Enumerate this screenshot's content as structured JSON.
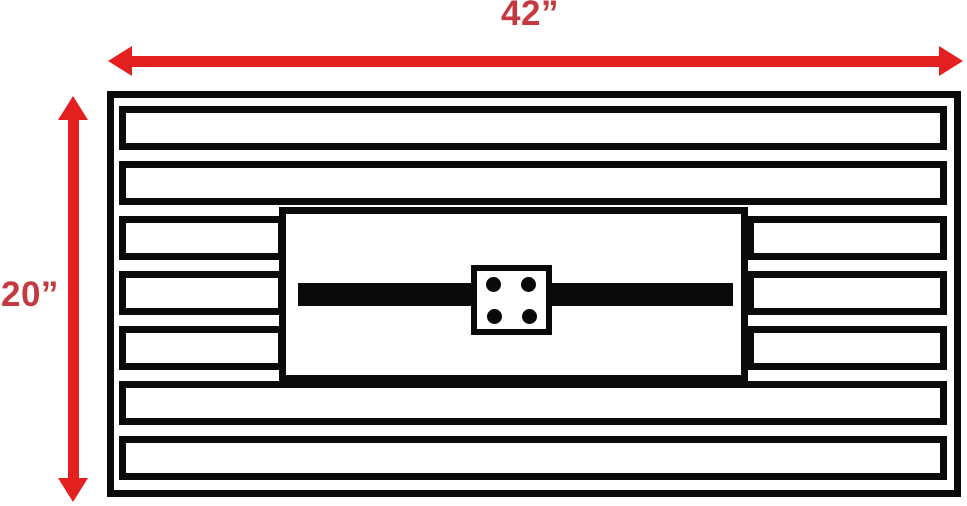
{
  "diagram": {
    "width_label": "42”",
    "height_label": "20”",
    "colors": {
      "dimension_arrow": "#e41f1f",
      "dimension_label": "#c53a40",
      "line": "#0a0a0a",
      "background": "#ffffff"
    },
    "structure": {
      "slat_rows": 7,
      "full_width_slat_rows": [
        1,
        2,
        6,
        7
      ],
      "split_slat_rows": [
        3,
        4,
        5
      ],
      "igniter_dot_count": 4
    }
  }
}
